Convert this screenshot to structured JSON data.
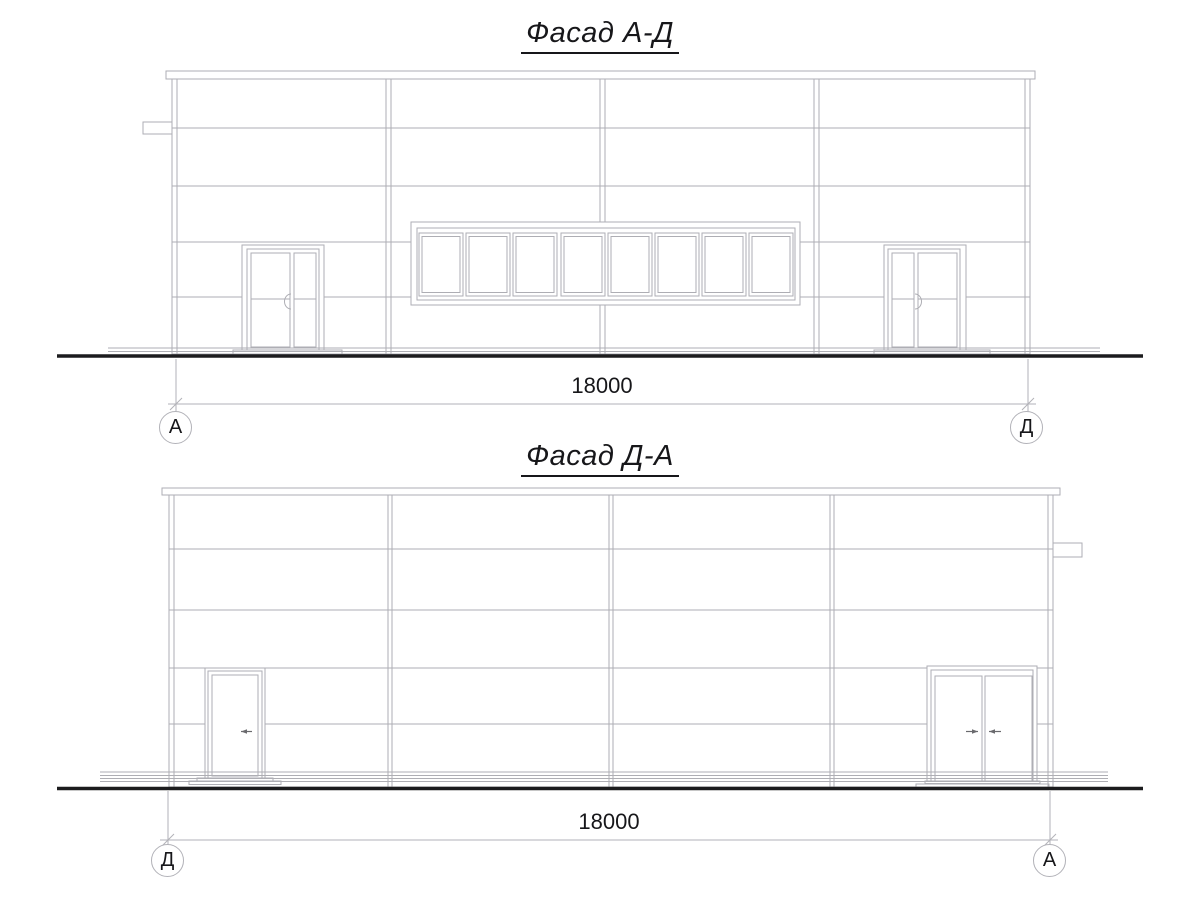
{
  "colors": {
    "background": "#ffffff",
    "line": "#aeaeb4",
    "dim": "#b2b2b8",
    "ground": "#1c1c1e",
    "text": "#17171a",
    "handle": "#6a6a6e"
  },
  "drawings": [
    {
      "title": "Фасад А-Д",
      "dimension": {
        "value": "18000"
      },
      "axes": {
        "left": "А",
        "right": "Д"
      }
    },
    {
      "title": "Фасад Д-А",
      "dimension": {
        "value": "18000"
      },
      "axes": {
        "left": "Д",
        "right": "А"
      }
    }
  ]
}
